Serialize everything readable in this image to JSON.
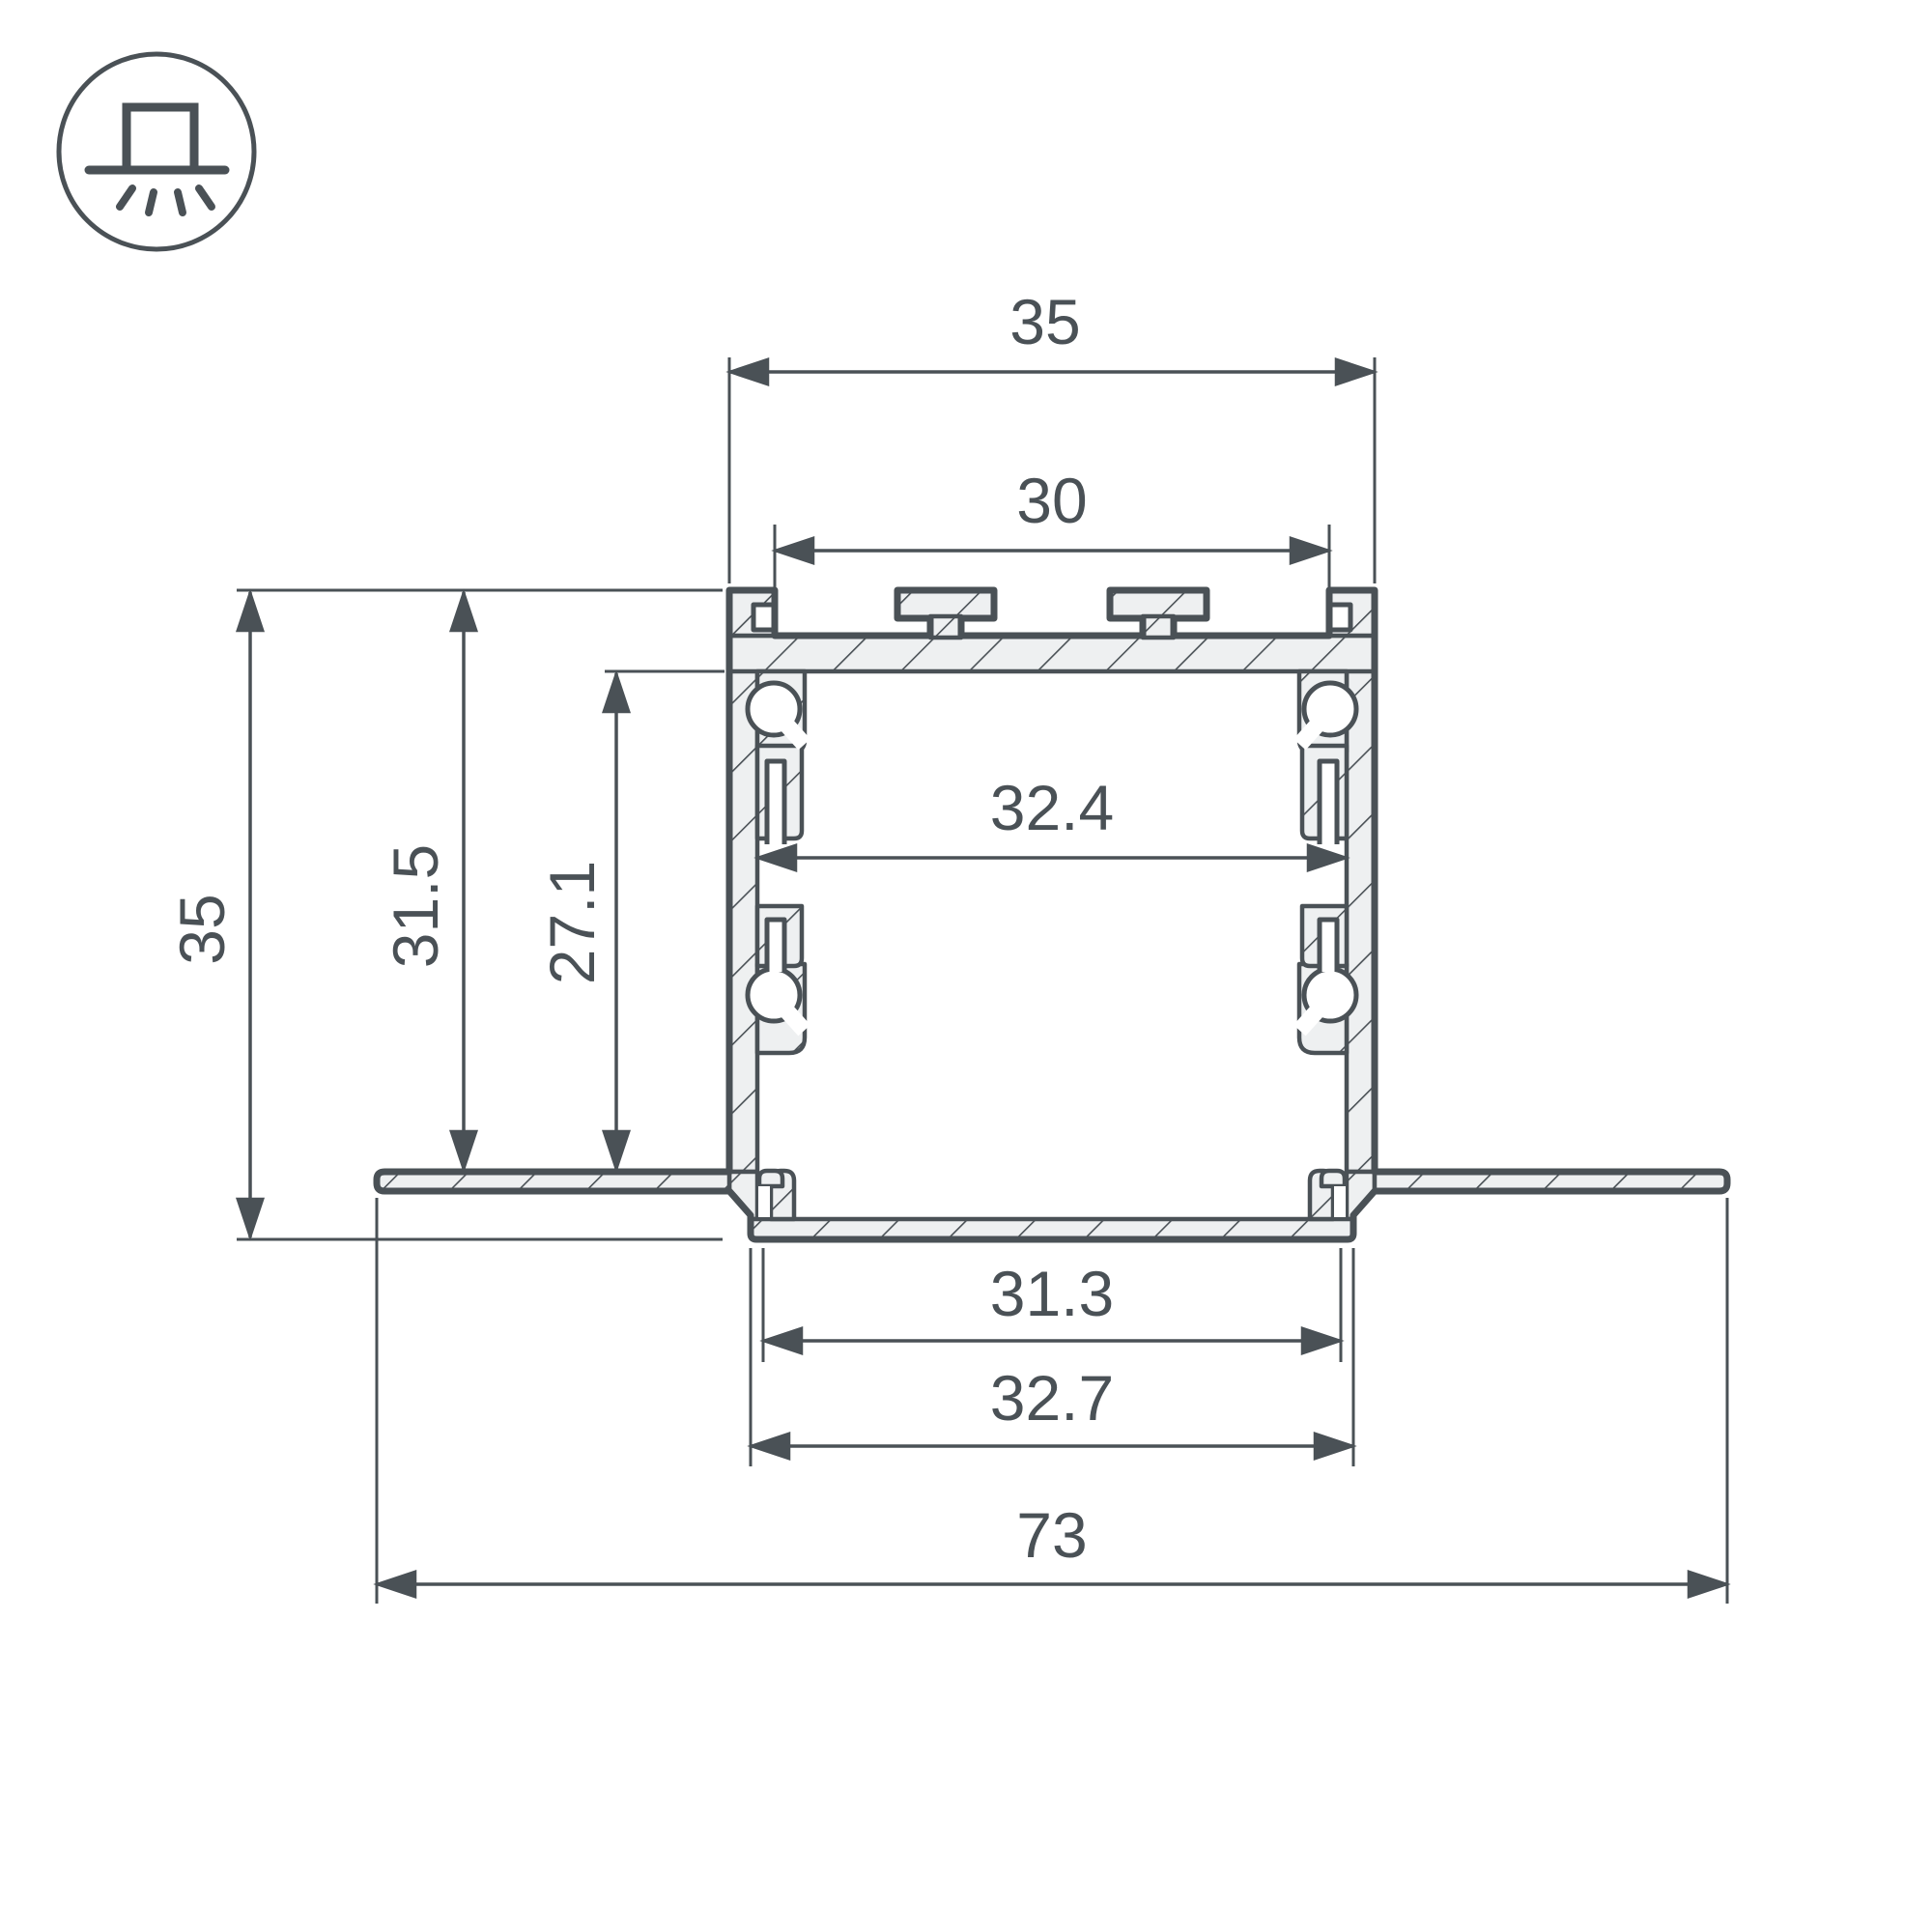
{
  "drawing": {
    "type": "aluminum-led-profile-cross-section",
    "style": "recessed-trimless-mounting",
    "hatching": "diagonal-section-hatch"
  },
  "icons": {
    "badge": "recessed-light-mount"
  },
  "colors": {
    "line": "#4a5156",
    "material_fill": "#eef0f1",
    "background": "#ffffff"
  },
  "dims": {
    "top_width": "35",
    "top_opening": "30",
    "inner_width": "32.4",
    "overall_height": "35",
    "depth_to_flange": "31.5",
    "inner_depth": "27.1",
    "bottom_opening": "31.3",
    "bottom_width": "32.7",
    "overall_width": "73"
  }
}
